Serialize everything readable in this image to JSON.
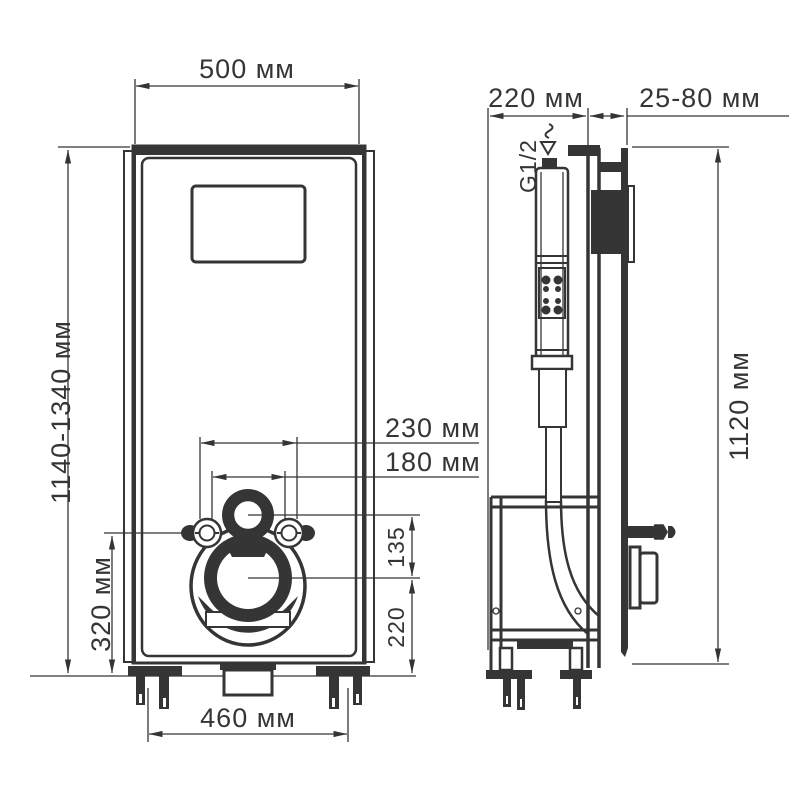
{
  "drawing": {
    "type": "technical-installation-diagram",
    "units": "мм",
    "front_view": {
      "width": "500 мм",
      "height_range": "1140-1340 мм",
      "fixing_studs_wide": "230 мм",
      "fixing_studs_narrow": "180 мм",
      "inlet_to_outlet": "135",
      "outlet_height": "220",
      "stud_height": "320 мм",
      "base_width": "460 мм"
    },
    "side_view": {
      "depth": "220 мм",
      "wall_distance": "25-80 мм",
      "height": "1120 мм",
      "water_connection": "G1/2"
    },
    "colors": {
      "line": "#353535",
      "background": "#ffffff"
    }
  }
}
